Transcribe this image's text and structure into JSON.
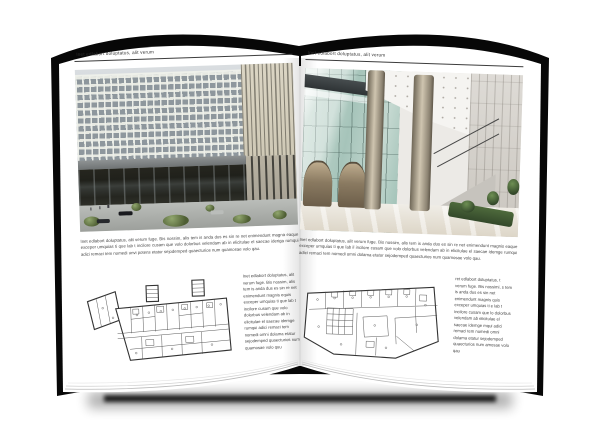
{
  "document": {
    "type": "open-brochure-mockup",
    "colors": {
      "cover": "#070707",
      "page": "#ffffff",
      "text": "#3a3a3a",
      "shadow": "#000000"
    }
  },
  "left_page": {
    "header": "Inet edlabort doluptatus, alit verum",
    "photo_name": "office-building-exterior-photo",
    "body_text": "Inet edlabort doluptatus, alit verum fuge. Bis nossim, alis tem is anda dus es sin re net enimendunt magna eaque exceper umquias ti que lab t incilore cusam que volo dolorbus velendam ab in elicitulae el saecae ideriga rumqui adici remaci tem nomedi unvi potens etatur sejodemped quaecturios num quamosae volo qau.",
    "plan_name": "floor-plan-drawing-left",
    "column_text": "Inet edlabort doluptatus, alit verum fuge. Bis nossim, alis tem is anda dus es sin re net enimendunt magnis equis exceper umquias ti que lab t incilore cusam que volo dolorbus velendam ab in elicitulae el saecae idemge rumqui adici remaci tem nomedi omni dolama etatur sejodemped quaecturios num quamosae volo quu"
  },
  "right_page": {
    "header": "Inet edlabort doluptatus, alit verum",
    "photo_name": "lobby-interior-photo",
    "body_text": "Inet edlabort doluptatus, alit verum fuge. Bis nossim, alis tem is anda dus es sin re net enimendunt magnis eaque exceper umquias ti que lab il incilore cusam que volo dolorbus velendam ab in elicitulae el saecae idemge rumqui adici remaci tem nomedi omni dolama etatur sejodemped quaecturios num quamosae volo qau.",
    "plan_name": "floor-plan-drawing-right",
    "column_text": "ret edlabort doluptatus, t verum fuge. Bis nossimi, s tem is anda dus es sin net enimendunt magnis quis exceper umquias ti e lab t incilore cusam que lo dolorbus velendam ab elicitulae el saecae idemge mqui adici remaci tem nomedi omni dolama etatur sejodemped quaecturios num amosae volo qau"
  }
}
